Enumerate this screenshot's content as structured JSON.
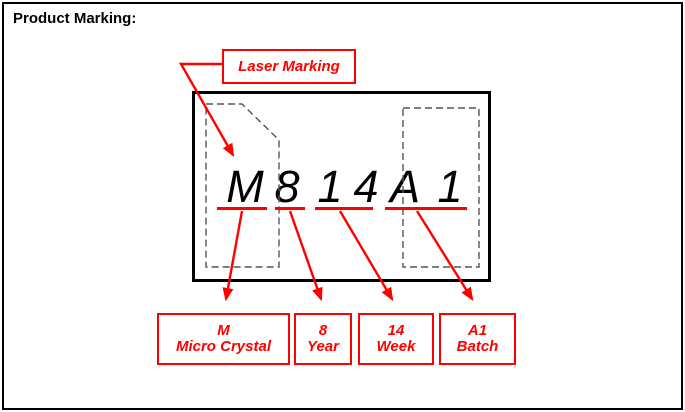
{
  "title": "Product Marking:",
  "callout": {
    "label": "Laser Marking"
  },
  "marking": {
    "chars": [
      "M",
      "8",
      "1",
      "4",
      "A",
      "1"
    ]
  },
  "legend": {
    "items": [
      {
        "code": "M",
        "meaning": "Micro Crystal"
      },
      {
        "code": "8",
        "meaning": "Year"
      },
      {
        "code": "14",
        "meaning": "Week"
      },
      {
        "code": "A1",
        "meaning": "Batch"
      }
    ]
  },
  "colors": {
    "accent": "#ff0000",
    "outline": "#000000",
    "dashed_zone": "#555555",
    "background": "#ffffff"
  }
}
